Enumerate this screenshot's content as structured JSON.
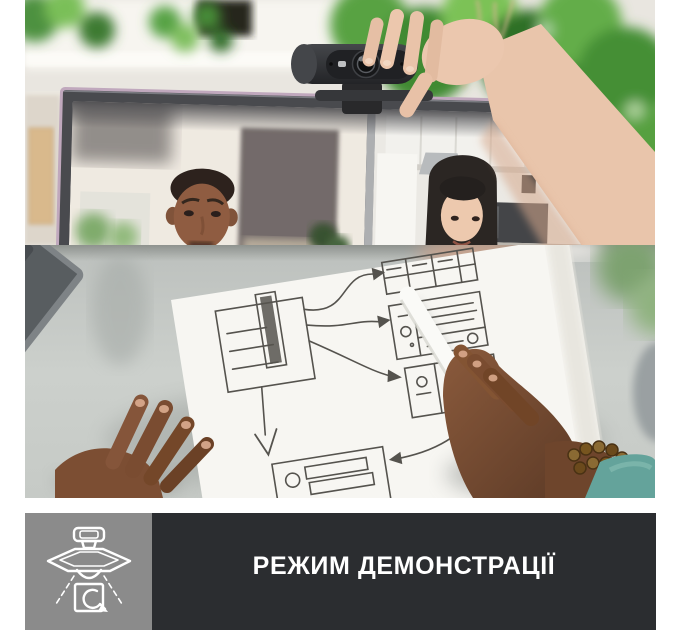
{
  "page": {
    "background_color": "#ffffff",
    "width": 680,
    "height": 630
  },
  "banner": {
    "label": "РЕЖИМ ДЕМОНСТРАЦІЇ",
    "text_color": "#ffffff",
    "bar_color": "#2b2d30",
    "icon_box_color": "#8b8b8b",
    "icon": "show-mode-icon"
  },
  "photo": {
    "alt": "A hand places a dark webcam on top of a monitor showing a video call with a man and a woman; below is the webcam's demonstration-mode view: two hands with a white stylus pointing at hand-drawn wireframe sketches on paper beside a keyboard.",
    "top_scene": "video-call-with-webcam-being-mounted",
    "bottom_scene": "overhead-desk-view-of-wireframe-sketches"
  }
}
